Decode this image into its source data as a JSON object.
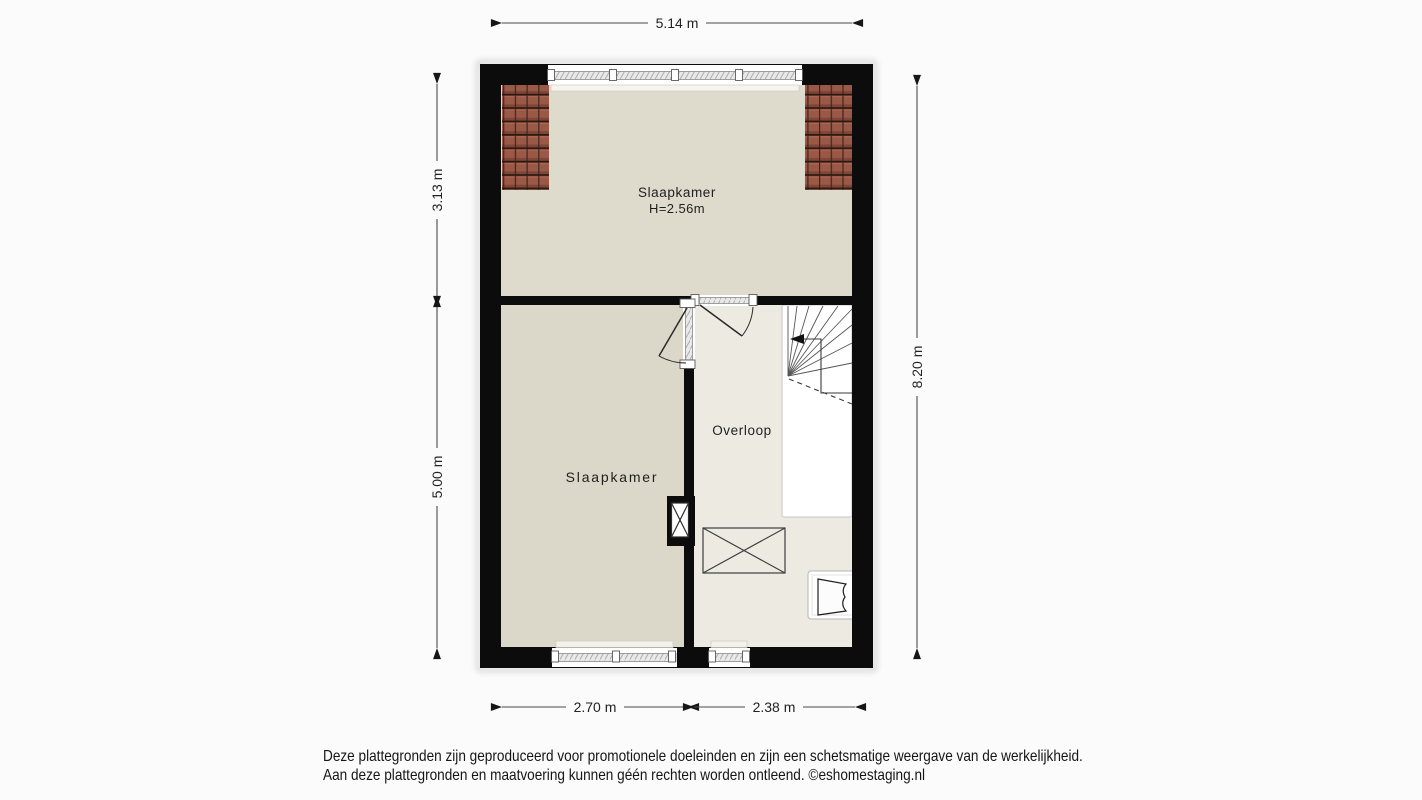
{
  "floorplan": {
    "rooms": {
      "bedroom_top": {
        "label": "Slaapkamer",
        "height": "H=2.56m"
      },
      "bedroom_bottom": {
        "label": "Slaapkamer"
      },
      "landing": {
        "label": "Overloop"
      }
    },
    "dimensions": {
      "top": "5.14 m",
      "left_upper": "3.13 m",
      "left_lower": "5.00 m",
      "right": "8.20 m",
      "bottom_left": "2.70 m",
      "bottom_right": "2.38 m"
    },
    "colors": {
      "wall": "#0c0c0c",
      "floor_bedroom_top": "#dedbcd",
      "floor_bedroom_bottom": "#dbd8c9",
      "floor_landing": "#edebe1",
      "roof_tile": "#9a5847",
      "stairwell": "#ffffff",
      "dimension_line": "#4a4a4a"
    }
  },
  "footer": {
    "line1": "Deze plattegronden zijn geproduceerd voor promotionele doeleinden en zijn een schetsmatige weergave van de werkelijkheid.",
    "line2": "Aan deze plattegronden en maatvoering kunnen géén rechten worden ontleend. ©eshomestaging.nl"
  }
}
